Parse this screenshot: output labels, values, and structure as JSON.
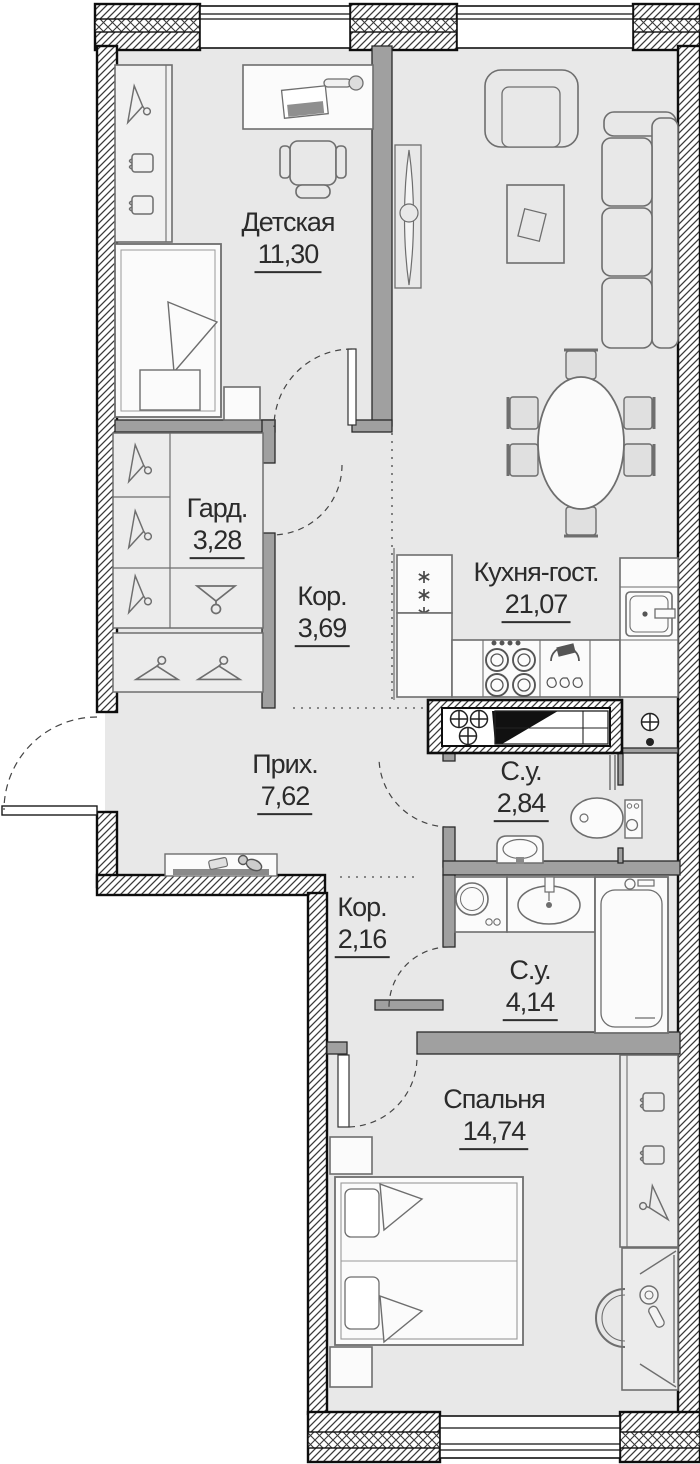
{
  "floorplan": {
    "rooms": [
      {
        "key": "children",
        "label": "Детская",
        "area": "11,30"
      },
      {
        "key": "wardrobe",
        "label": "Гард.",
        "area": "3,28"
      },
      {
        "key": "corridor1",
        "label": "Кор.",
        "area": "3,69"
      },
      {
        "key": "kitchen_living",
        "label": "Кухня-гост.",
        "area": "21,07"
      },
      {
        "key": "hallway",
        "label": "Прих.",
        "area": "7,62"
      },
      {
        "key": "bathroom1",
        "label": "С.у.",
        "area": "2,84"
      },
      {
        "key": "corridor2",
        "label": "Кор.",
        "area": "2,16"
      },
      {
        "key": "bathroom2",
        "label": "С.у.",
        "area": "4,14"
      },
      {
        "key": "bedroom",
        "label": "Спальня",
        "area": "14,74"
      }
    ],
    "colors": {
      "floor": "#e8e8e8",
      "walls": "#0d0d0d",
      "partitions": "#a0a0a0",
      "furniture_outline": "#6e6e6e",
      "label_text": "#2b2b2b"
    },
    "icons": [
      "hanger-icon",
      "folded-clothes-icon",
      "snowflake-icon",
      "burner-icon",
      "vent-icon",
      "key-icon",
      "mirror-icon"
    ]
  }
}
